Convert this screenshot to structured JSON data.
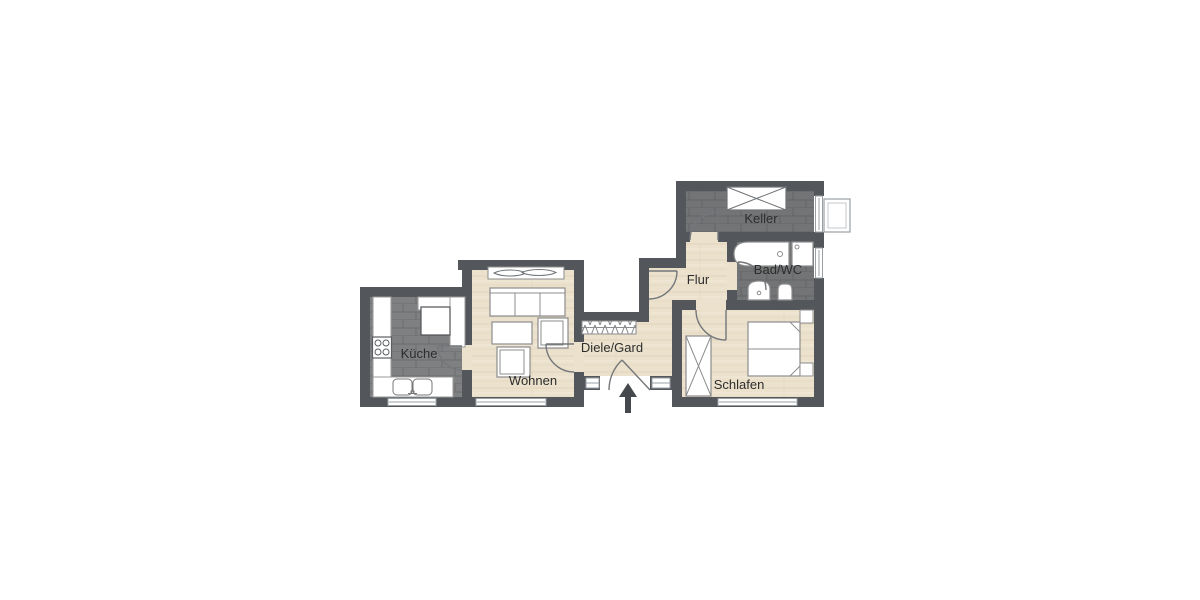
{
  "floorplan": {
    "rooms": [
      {
        "id": "kueche",
        "label": "Küche",
        "floor": "tile"
      },
      {
        "id": "wohnen",
        "label": "Wohnen",
        "floor": "wood"
      },
      {
        "id": "diele",
        "label": "Diele/Gard",
        "floor": "wood"
      },
      {
        "id": "flur",
        "label": "Flur",
        "floor": "wood"
      },
      {
        "id": "bad",
        "label": "Bad/WC",
        "floor": "tile"
      },
      {
        "id": "keller",
        "label": "Keller",
        "floor": "tile"
      },
      {
        "id": "schlafen",
        "label": "Schlafen",
        "floor": "wood"
      }
    ],
    "colors": {
      "background": "#ffffff",
      "wall": "#53565b",
      "tile_floor_light": "#7f8082",
      "tile_floor_dark": "#737476",
      "wood_floor": "#ebe1cc",
      "furniture_outline": "#8d8d8d",
      "label_text": "#2d2d2d",
      "entrance_arrow": "#45484c"
    },
    "entrance": {
      "arrow_direction": "up"
    }
  }
}
